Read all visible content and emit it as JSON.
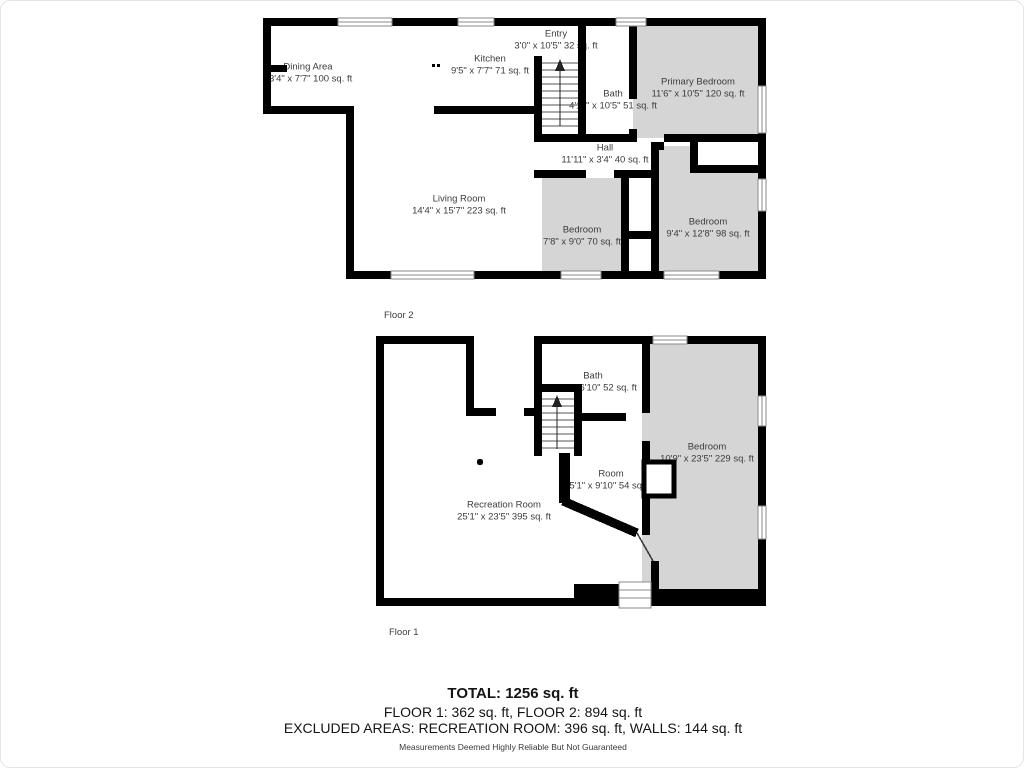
{
  "floor2": {
    "label": "Floor 2",
    "rooms": [
      {
        "name": "Dining Area",
        "dims": "13'4\" x 7'7\" 100 sq. ft"
      },
      {
        "name": "Kitchen",
        "dims": "9'5\" x 7'7\" 71 sq. ft"
      },
      {
        "name": "Entry",
        "dims": "3'0\" x 10'5\" 32 sq. ft"
      },
      {
        "name": "Bath",
        "dims": "4'11\" x 10'5\" 51 sq. ft"
      },
      {
        "name": "Primary Bedroom",
        "dims": "11'6\" x 10'5\" 120 sq. ft"
      },
      {
        "name": "Hall",
        "dims": "11'11\" x 3'4\" 40 sq. ft"
      },
      {
        "name": "Living Room",
        "dims": "14'4\" x 15'7\" 223 sq. ft"
      },
      {
        "name": "Bedroom",
        "dims": "7'8\" x 9'0\" 70 sq. ft"
      },
      {
        "name": "Bedroom",
        "dims": "9'4\" x 12'8\" 98 sq. ft"
      }
    ]
  },
  "floor1": {
    "label": "Floor 1",
    "rooms": [
      {
        "name": "Bath",
        "dims": "7'11\" x 6'10\" 52 sq. ft"
      },
      {
        "name": "Bedroom",
        "dims": "10'9\" x 23'5\" 229 sq. ft"
      },
      {
        "name": "Room",
        "dims": "5'1\" x 9'10\" 54 sq. ft"
      },
      {
        "name": "Recreation Room",
        "dims": "25'1\" x 23'5\" 395 sq. ft"
      }
    ]
  },
  "summary": {
    "total": "TOTAL: 1256 sq. ft",
    "floors": "FLOOR 1: 362 sq. ft, FLOOR 2: 894 sq. ft",
    "excluded": "EXCLUDED AREAS: RECREATION ROOM: 396 sq. ft, WALLS: 144 sq. ft",
    "disclaimer": "Measurements Deemed Highly Reliable But Not Guaranteed"
  },
  "colors": {
    "wall": "#000000",
    "carpet_fill": "#d5d5d5",
    "label_text": "#3c3c3c",
    "summary_text": "#141414"
  }
}
